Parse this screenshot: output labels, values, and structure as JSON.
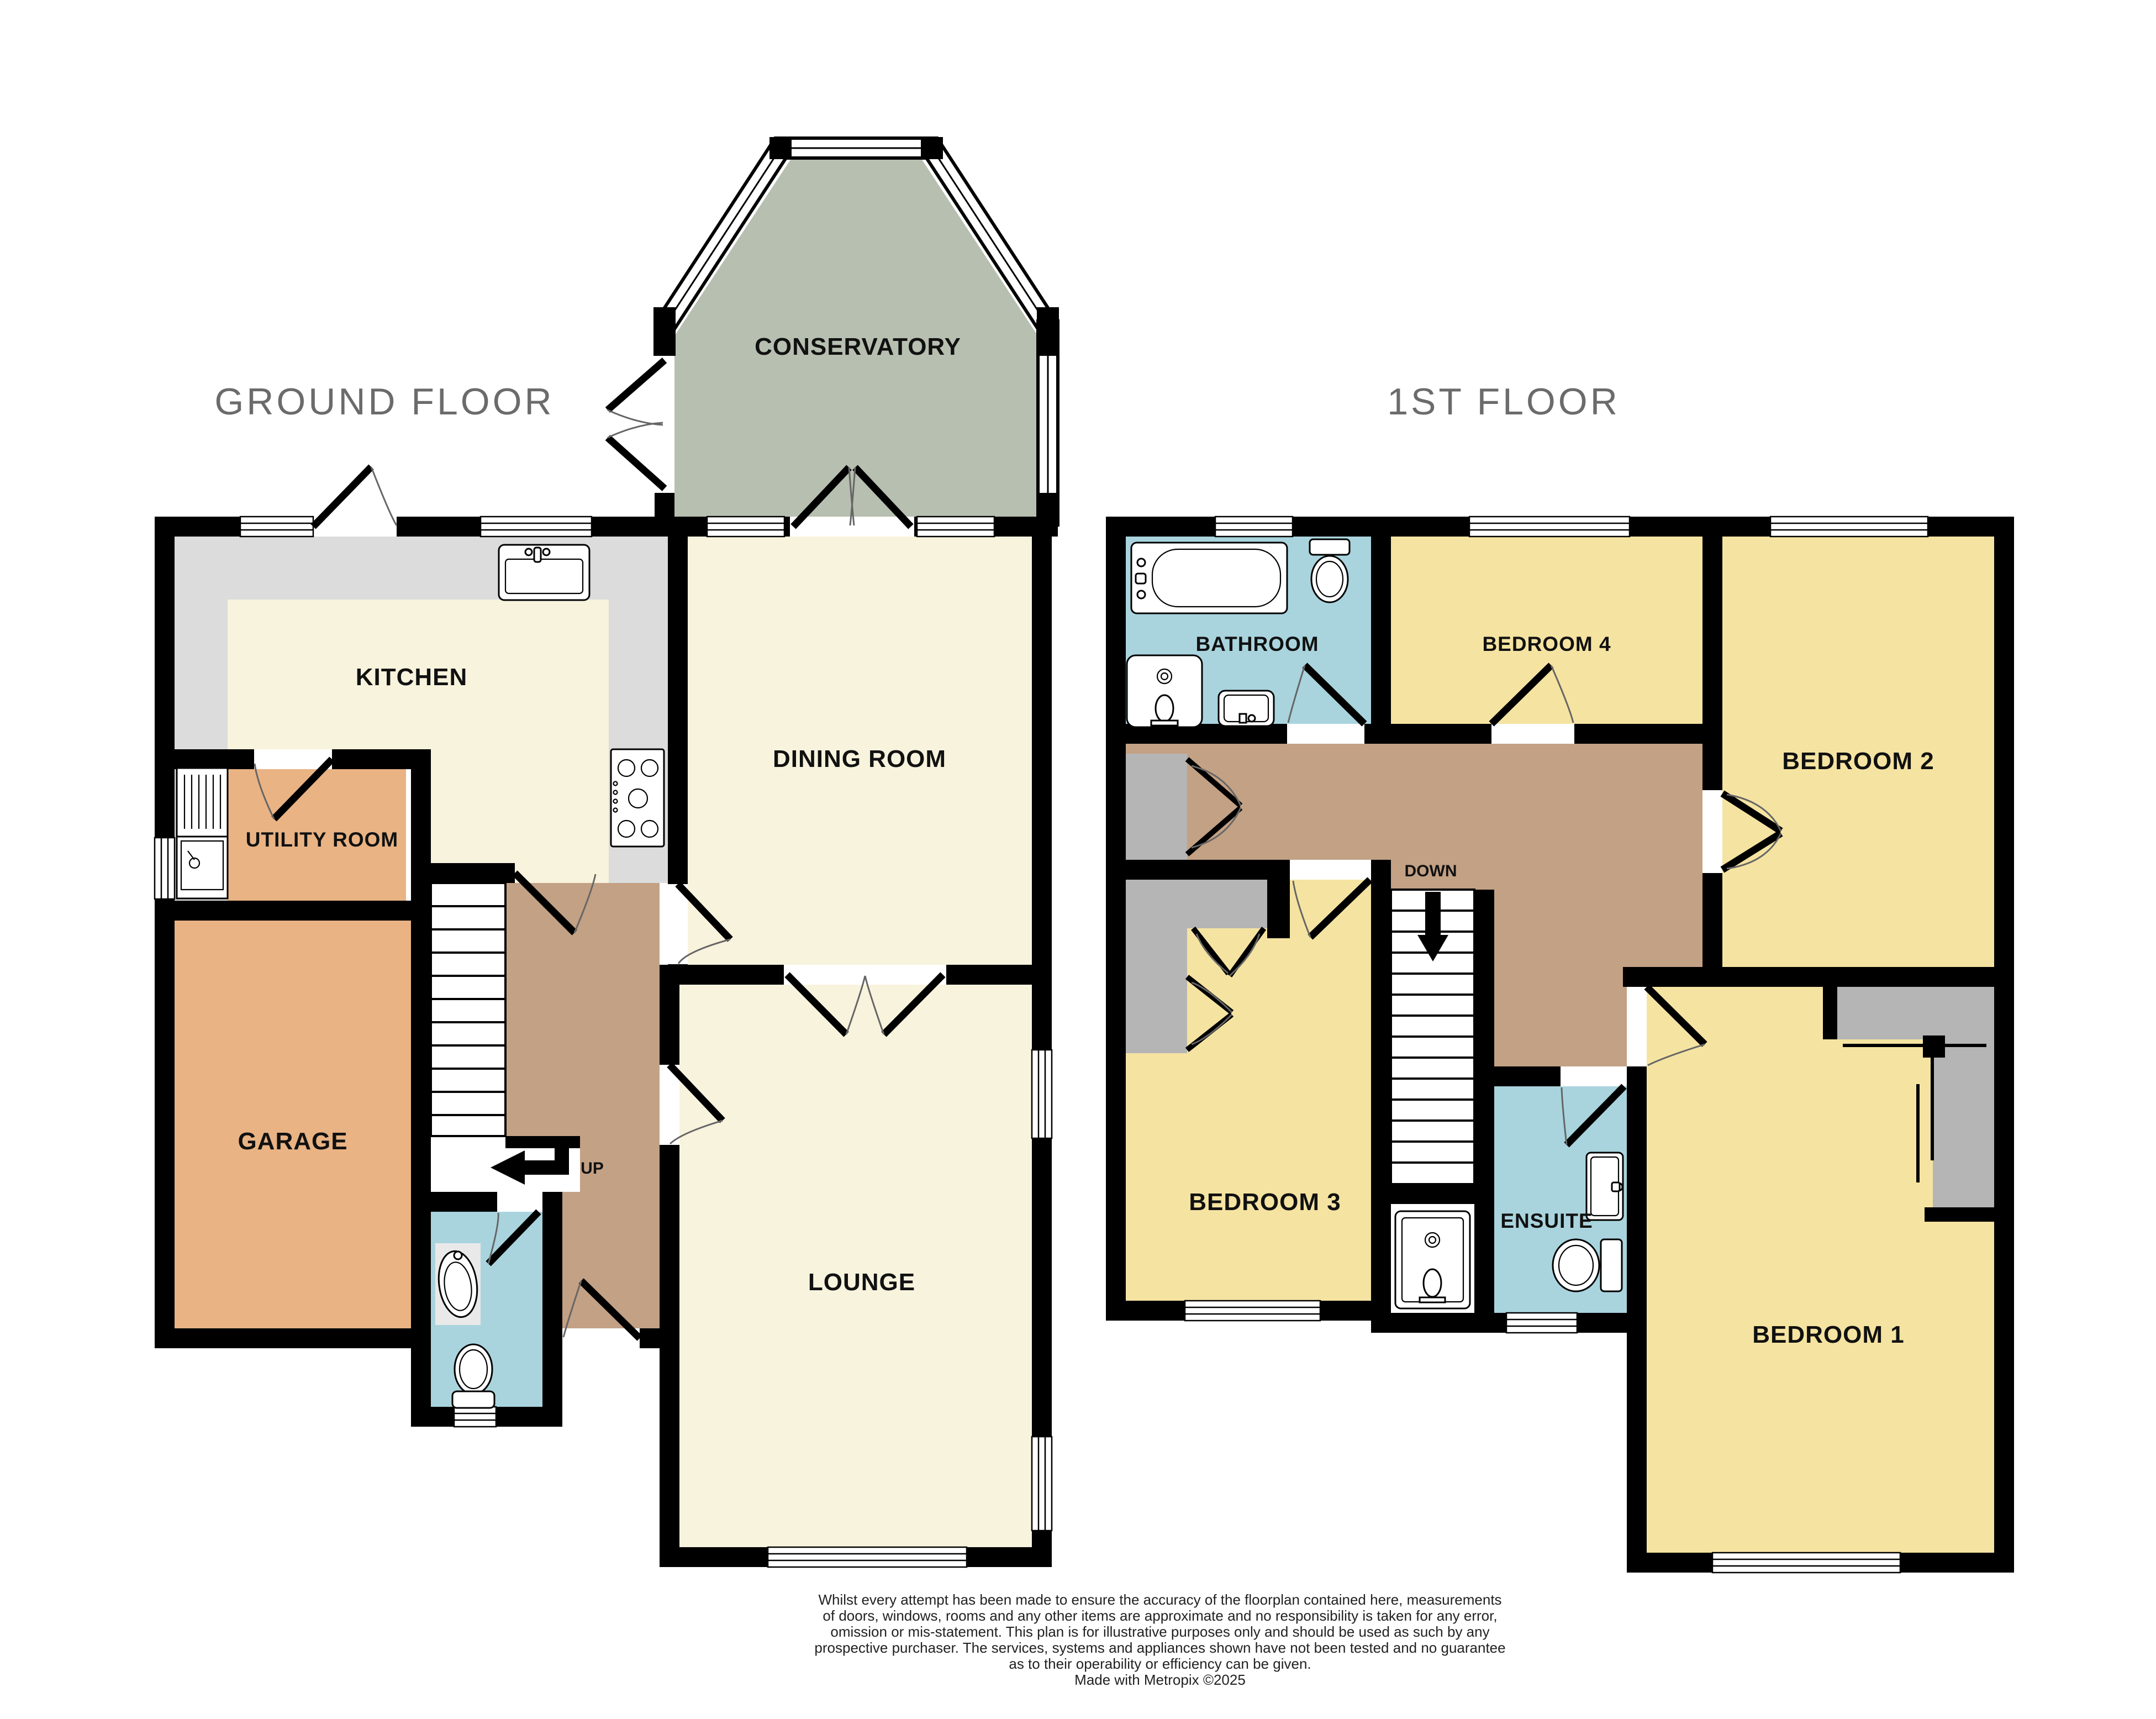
{
  "floorplan": {
    "titles": {
      "ground": "GROUND FLOOR",
      "first": "1ST FLOOR"
    },
    "ground_floor": {
      "rooms": {
        "conservatory": "CONSERVATORY",
        "kitchen": "KITCHEN",
        "dining": "DINING ROOM",
        "utility": "UTILITY ROOM",
        "garage": "GARAGE",
        "lounge": "LOUNGE"
      },
      "stairs_label": "UP"
    },
    "first_floor": {
      "rooms": {
        "bathroom": "BATHROOM",
        "bedroom4": "BEDROOM 4",
        "bedroom2": "BEDROOM 2",
        "bedroom3": "BEDROOM 3",
        "ensuite": "ENSUITE",
        "bedroom1": "BEDROOM 1"
      },
      "stairs_label": "DOWN"
    },
    "disclaimer": [
      "Whilst every attempt has been made to ensure the accuracy of the floorplan contained here, measurements",
      "of doors, windows, rooms and any other items are approximate and no responsibility is taken for any error,",
      "omission or mis-statement. This plan is for illustrative purposes only and should be used as such by any",
      "prospective purchaser. The services, systems and appliances shown have not been tested and no guarantee",
      "as to their operability or efficiency can be given.",
      "Made with Metropix ©2025"
    ]
  },
  "colors": {
    "wall": "#000000",
    "cream": "#f8f3dd",
    "yellow": "#f5e3a1",
    "blue": "#a9d4de",
    "brown": "#c3a184",
    "orange": "#e9b384",
    "conservatory": "#b7bfb0",
    "counter": "#dcdcdc",
    "cupboard": "#b5b5b5",
    "fixture_mat": "#e9e9e9",
    "title": "#6b6b6b",
    "label": "#111111",
    "disclaimer": "#222222"
  }
}
